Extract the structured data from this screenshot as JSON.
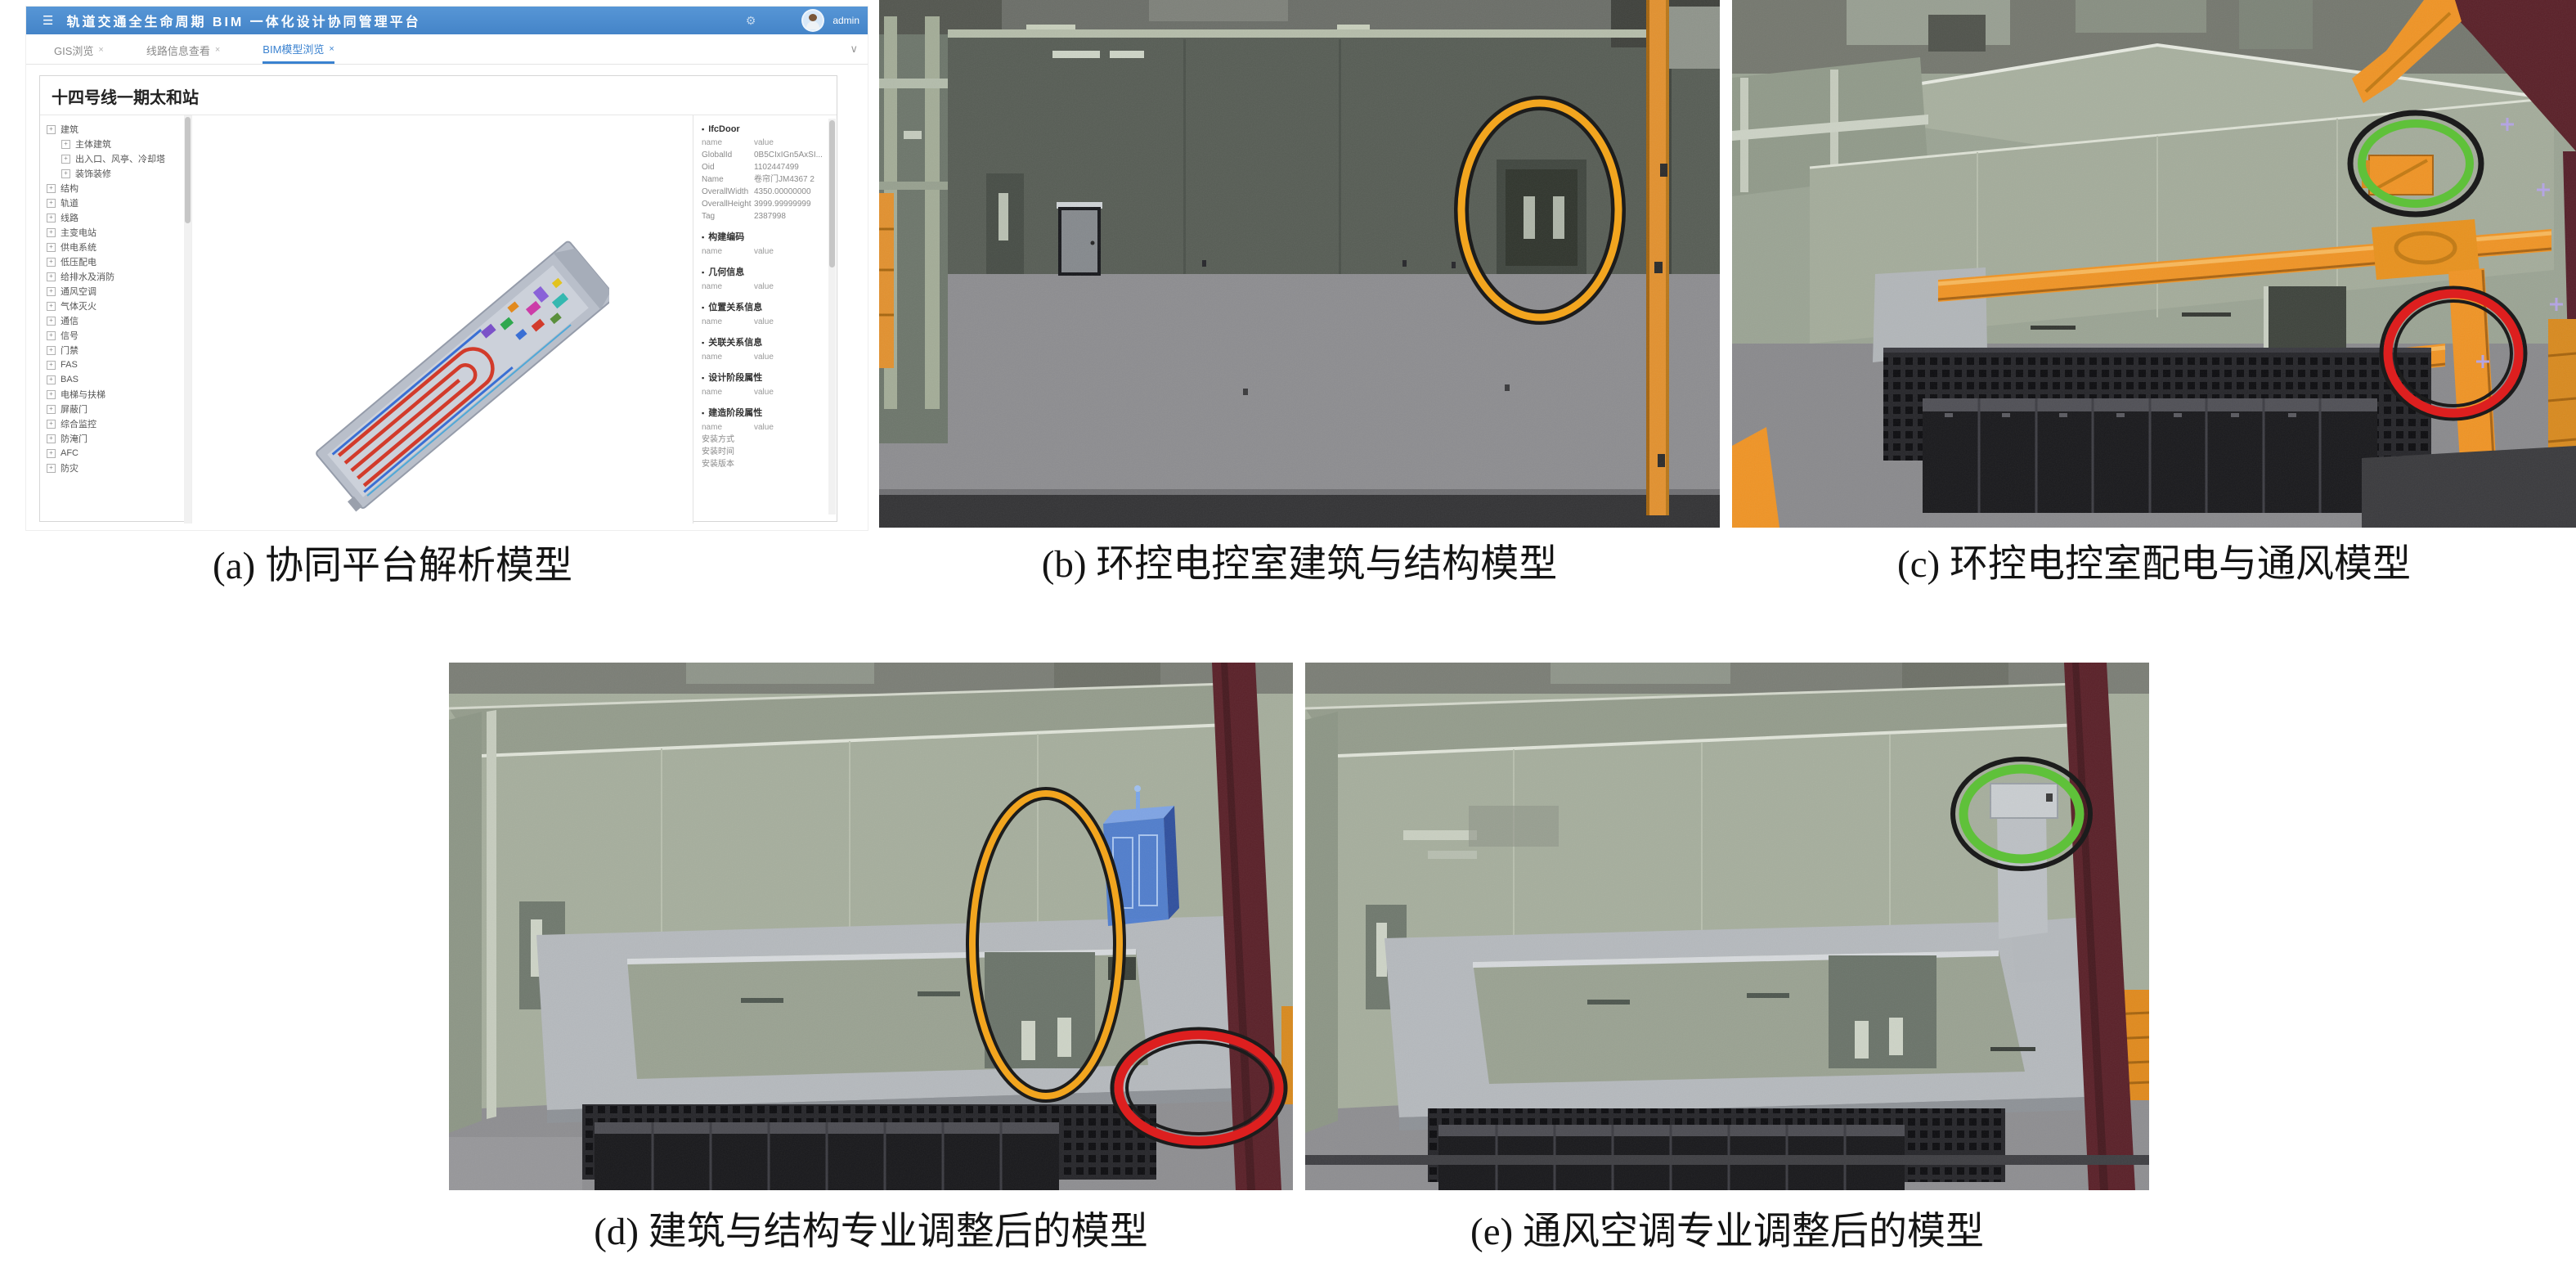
{
  "colors": {
    "titlebar_blue": "#4b8ed2",
    "active_tab_blue": "#3a82d0",
    "annotation_orange": "#f2a51f",
    "annotation_red": "#dd1f1f",
    "annotation_green": "#5fc13a",
    "annotation_outline": "#1c1c1c",
    "duct_orange": "#ef9426",
    "wall_green_grey": "#a5ad9c",
    "maroon_wall": "#5a2129"
  },
  "captions": {
    "a": "(a) 协同平台解析模型",
    "b": "(b) 环控电控室建筑与结构模型",
    "c": "(c) 环控电控室配电与通风模型",
    "d": "(d) 建筑与结构专业调整后的模型",
    "e": "(e) 通风空调专业调整后的模型"
  },
  "platform": {
    "title": "轨道交通全生命周期 BIM 一体化设计协同管理平台",
    "user": "admin",
    "icons": {
      "hamburger": "☰",
      "gear": "⚙",
      "chevron_down": "∨",
      "close": "×",
      "section_marker": "▪",
      "expander_plus": "+"
    },
    "tabs": [
      {
        "label": "GIS浏览",
        "active": false
      },
      {
        "label": "线路信息查看",
        "active": false
      },
      {
        "label": "BIM模型浏览",
        "active": true
      }
    ],
    "page_title": "十四号线一期太和站",
    "tree": {
      "items": [
        {
          "label": "建筑",
          "level": 0
        },
        {
          "label": "主体建筑",
          "level": 1
        },
        {
          "label": "出入口、风亭、冷却塔",
          "level": 1
        },
        {
          "label": "装饰装修",
          "level": 1
        },
        {
          "label": "结构",
          "level": 0
        },
        {
          "label": "轨道",
          "level": 0
        },
        {
          "label": "线路",
          "level": 0
        },
        {
          "label": "主变电站",
          "level": 0
        },
        {
          "label": "供电系统",
          "level": 0
        },
        {
          "label": "低压配电",
          "level": 0
        },
        {
          "label": "给排水及消防",
          "level": 0
        },
        {
          "label": "通风空调",
          "level": 0
        },
        {
          "label": "气体灭火",
          "level": 0
        },
        {
          "label": "通信",
          "level": 0
        },
        {
          "label": "信号",
          "level": 0
        },
        {
          "label": "门禁",
          "level": 0
        },
        {
          "label": "FAS",
          "level": 0
        },
        {
          "label": "BAS",
          "level": 0
        },
        {
          "label": "电梯与扶梯",
          "level": 0
        },
        {
          "label": "屏蔽门",
          "level": 0
        },
        {
          "label": "综合监控",
          "level": 0
        },
        {
          "label": "防淹门",
          "level": 0
        },
        {
          "label": "AFC",
          "level": 0
        },
        {
          "label": "防灾",
          "level": 0
        }
      ]
    },
    "properties": {
      "sections": [
        {
          "title": "IfcDoor",
          "header": [
            "name",
            "value"
          ],
          "rows": [
            [
              "GlobalId",
              "0B5CIxIGn5AxSI..."
            ],
            [
              "Oid",
              "1102447499"
            ],
            [
              "Name",
              "卷帘门JM4367 2"
            ],
            [
              "OverallWidth",
              "4350.00000000"
            ],
            [
              "OverallHeight",
              "3999.99999999"
            ],
            [
              "Tag",
              "2387998"
            ]
          ]
        },
        {
          "title": "构建编码",
          "header": [
            "name",
            "value"
          ],
          "rows": []
        },
        {
          "title": "几何信息",
          "header": [
            "name",
            "value"
          ],
          "rows": []
        },
        {
          "title": "位置关系信息",
          "header": [
            "name",
            "value"
          ],
          "rows": []
        },
        {
          "title": "关联关系信息",
          "header": [
            "name",
            "value"
          ],
          "rows": []
        },
        {
          "title": "设计阶段属性",
          "header": [
            "name",
            "value"
          ],
          "rows": []
        },
        {
          "title": "建造阶段属性",
          "header": [
            "name",
            "value"
          ],
          "rows": [
            [
              "安装方式",
              ""
            ],
            [
              "安装时间",
              ""
            ],
            [
              "安装版本",
              ""
            ]
          ]
        }
      ]
    }
  }
}
